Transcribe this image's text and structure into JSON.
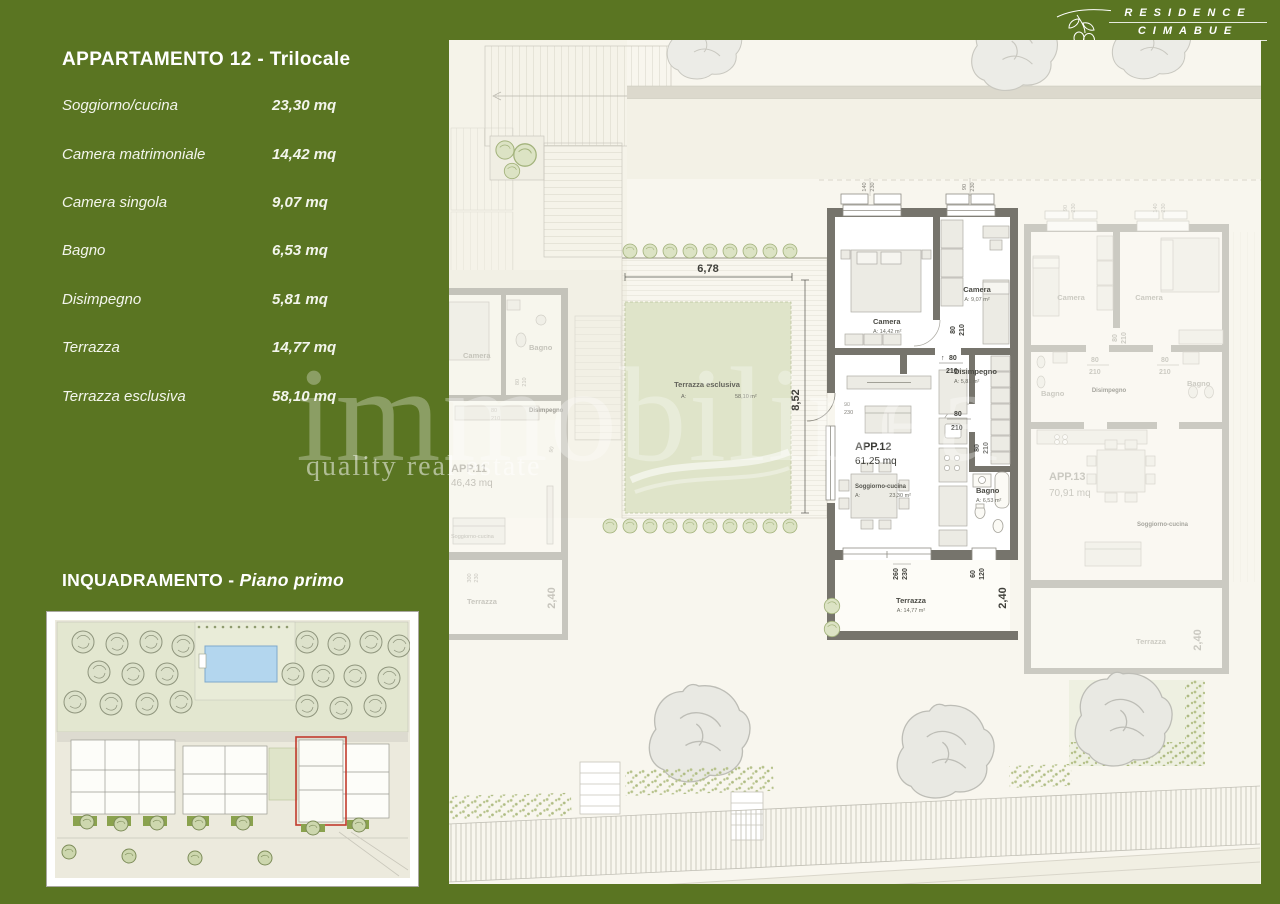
{
  "brand": {
    "line1": "RESIDENCE",
    "line2": "CIMABUE"
  },
  "apartment_panel": {
    "title": "APPARTAMENTO 12 - Trilocale",
    "rooms": [
      {
        "label": "Soggiorno/cucina",
        "value": "23,30 mq"
      },
      {
        "label": "Camera matrimoniale",
        "value": "14,42 mq"
      },
      {
        "label": "Camera singola",
        "value": "9,07 mq"
      },
      {
        "label": "Bagno",
        "value": "6,53 mq"
      },
      {
        "label": "Disimpegno",
        "value": "5,81 mq"
      },
      {
        "label": "Terrazza",
        "value": "14,77 mq"
      },
      {
        "label": "Terrazza esclusiva",
        "value": "58,10 mq"
      }
    ]
  },
  "inquadramento": {
    "title": "INQUADRAMENTO",
    "separator": " - ",
    "subtitle": "Piano primo"
  },
  "watermark": {
    "line1": "immobilinea",
    "line2": "quality real estate"
  },
  "floorplan": {
    "arrow_up": "↑",
    "dims": {
      "d140": "140",
      "d230": "230",
      "d90": "90",
      "d80": "80",
      "d210": "210",
      "d260": "260",
      "d60": "60",
      "d120": "120",
      "d300": "300",
      "d678": "6,78",
      "d852": "8,52",
      "d240": "2,40"
    },
    "terrazza_esclusiva": {
      "name": "Terrazza esclusiva",
      "a": "A:",
      "area_val": "58,10 m²"
    },
    "app12": {
      "name": "APP.12",
      "area": "61,25 mq",
      "camera1": {
        "name": "Camera",
        "area": "A: 14,42 m²"
      },
      "camera2": {
        "name": "Camera",
        "area": "A: 9,07 m²"
      },
      "disimpegno": {
        "name": "Disimpegno",
        "area": "A: 5,81 m²"
      },
      "bagno": {
        "name": "Bagno",
        "area": "A: 6,53 m²"
      },
      "soggiorno": {
        "name": "Soggiorno-cucina",
        "a": "A:",
        "area_val": "23,30 m²"
      },
      "terrazza": {
        "name": "Terrazza",
        "area": "A: 14,77 m²"
      }
    },
    "app11": {
      "name": "APP.11",
      "area": "46,43 mq",
      "camera": "Camera",
      "bagno": "Bagno",
      "disimpegno": "Disimpegno",
      "soggiorno": "Soggiorno-cucina",
      "terrazza": "Terrazza"
    },
    "app13": {
      "name": "APP.13",
      "area": "70,91 mq",
      "camera1": "Camera",
      "camera2": "Camera",
      "bagno1": "Bagno",
      "bagno2": "Bagno",
      "disimpegno": "Disimpegno",
      "soggiorno": "Soggiorno-cucina",
      "terrazza": "Terrazza"
    }
  }
}
